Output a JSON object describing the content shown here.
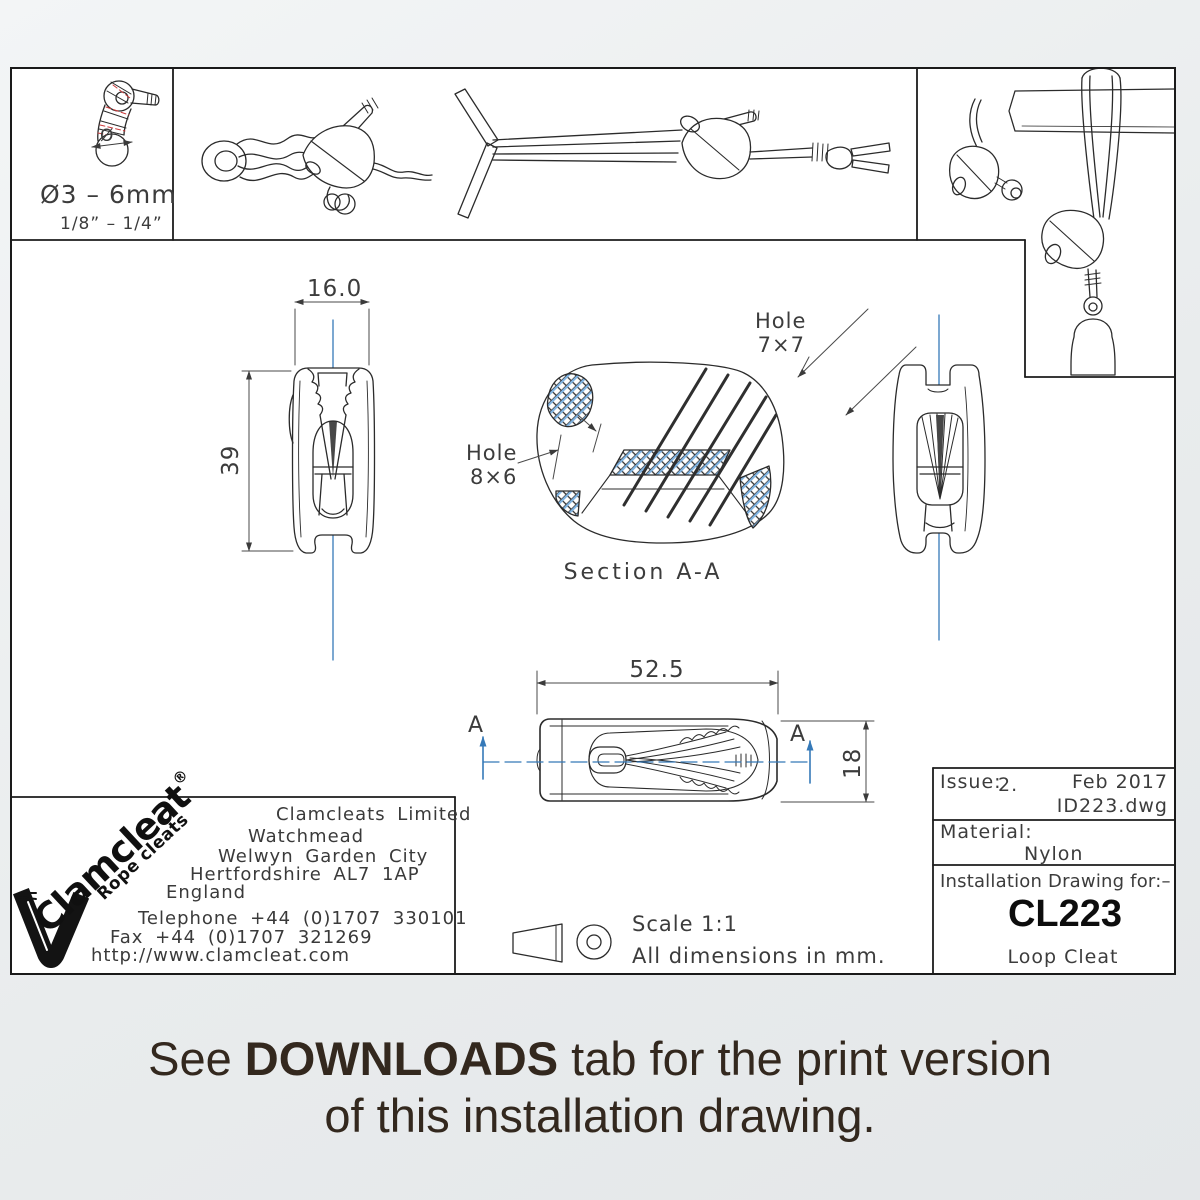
{
  "banner": {
    "line1_prefix": "See ",
    "line1_bold": "DOWNLOADS",
    "line1_suffix": " tab for the print version",
    "line2": "of this installation drawing."
  },
  "rope_panel": {
    "diameter_symbol": "Ø",
    "metric": "Ø3 – 6mm",
    "imperial": "1/8” – 1/4”"
  },
  "dimensions": {
    "front_width": "16.0",
    "front_height": "39",
    "top_length": "52.5",
    "top_depth": "18"
  },
  "section": {
    "label": "Section A-A",
    "marker": "A",
    "hole_top_word": "Hole",
    "hole_top_size": "7×7",
    "hole_side_word": "Hole",
    "hole_side_size": "8×6"
  },
  "notes": {
    "scale": "Scale 1:1",
    "units": "All dimensions in mm."
  },
  "company": {
    "logo_text": "Clamcleat",
    "logo_reg": "®",
    "logo_tagline": "Rope cleats",
    "name": "Clamcleats Limited",
    "address_line1": "Watchmead",
    "address_line2": "Welwyn Garden City",
    "address_line3": "Hertfordshire AL7 1AP",
    "address_line4": "England",
    "telephone": "Telephone +44 (0)1707 330101",
    "fax": "Fax +44 (0)1707 321269",
    "website": "http://www.clamcleat.com"
  },
  "titleblock": {
    "issue_label": "Issue:",
    "issue_value": "2.",
    "date": "Feb 2017",
    "file": "ID223.dwg",
    "material_label": "Material:",
    "material_value": "Nylon",
    "for_label": "Installation Drawing for:–",
    "part_number": "CL223",
    "part_name": "Loop Cleat"
  },
  "colors": {
    "centerline_blue": "#3579b8",
    "hatch_blue": "#7fb2e0",
    "rope_red": "#cc3b3b",
    "line_dark": "#2b2b2b"
  }
}
